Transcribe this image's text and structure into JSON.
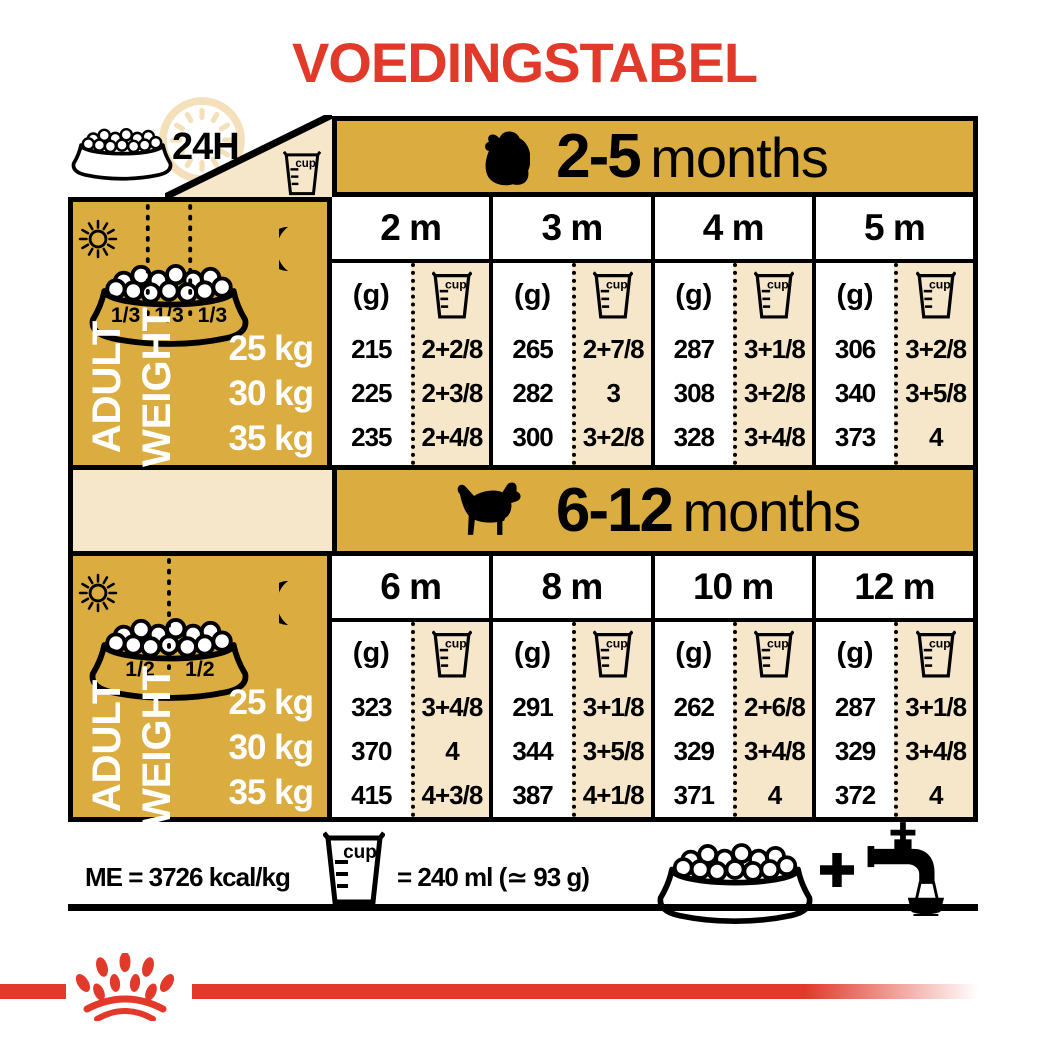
{
  "title": "VOEDINGSTABEL",
  "colors": {
    "red": "#E13A2B",
    "gold": "#DBAD41",
    "beige": "#F6E7CB",
    "clock_ring": "#F4E0BA"
  },
  "cup_word": "cup",
  "header_icons": {
    "label_24h": "24H"
  },
  "left_panel": {
    "adult_label": "ADULT",
    "weight_label": "WEIGHT"
  },
  "sections": [
    {
      "range_bold": "2-5",
      "range_rest": "months",
      "unit": "(g)",
      "fractions": [
        "1/3",
        "1/3",
        "1/3"
      ],
      "weights": [
        "25 kg",
        "30 kg",
        "35 kg"
      ],
      "columns": [
        {
          "month": "2 m",
          "g": [
            "215",
            "225",
            "235"
          ],
          "cup": [
            "2+2/8",
            "2+3/8",
            "2+4/8"
          ]
        },
        {
          "month": "3 m",
          "g": [
            "265",
            "282",
            "300"
          ],
          "cup": [
            "2+7/8",
            "3",
            "3+2/8"
          ]
        },
        {
          "month": "4 m",
          "g": [
            "287",
            "308",
            "328"
          ],
          "cup": [
            "3+1/8",
            "3+2/8",
            "3+4/8"
          ]
        },
        {
          "month": "5 m",
          "g": [
            "306",
            "340",
            "373"
          ],
          "cup": [
            "3+2/8",
            "3+5/8",
            "4"
          ]
        }
      ]
    },
    {
      "range_bold": "6-12",
      "range_rest": "months",
      "unit": "(g)",
      "fractions": [
        "1/2",
        "1/2"
      ],
      "weights": [
        "25 kg",
        "30 kg",
        "35 kg"
      ],
      "columns": [
        {
          "month": "6 m",
          "g": [
            "323",
            "370",
            "415"
          ],
          "cup": [
            "3+4/8",
            "4",
            "4+3/8"
          ]
        },
        {
          "month": "8 m",
          "g": [
            "291",
            "344",
            "387"
          ],
          "cup": [
            "3+1/8",
            "3+5/8",
            "4+1/8"
          ]
        },
        {
          "month": "10 m",
          "g": [
            "262",
            "329",
            "371"
          ],
          "cup": [
            "2+6/8",
            "3+4/8",
            "4"
          ]
        },
        {
          "month": "12 m",
          "g": [
            "287",
            "329",
            "372"
          ],
          "cup": [
            "3+1/8",
            "3+4/8",
            "4"
          ]
        }
      ]
    }
  ],
  "footer": {
    "me_text": "ME = 3726 kcal/kg",
    "cup_eq_text": "= 240 ml (≃ 93 g)"
  }
}
